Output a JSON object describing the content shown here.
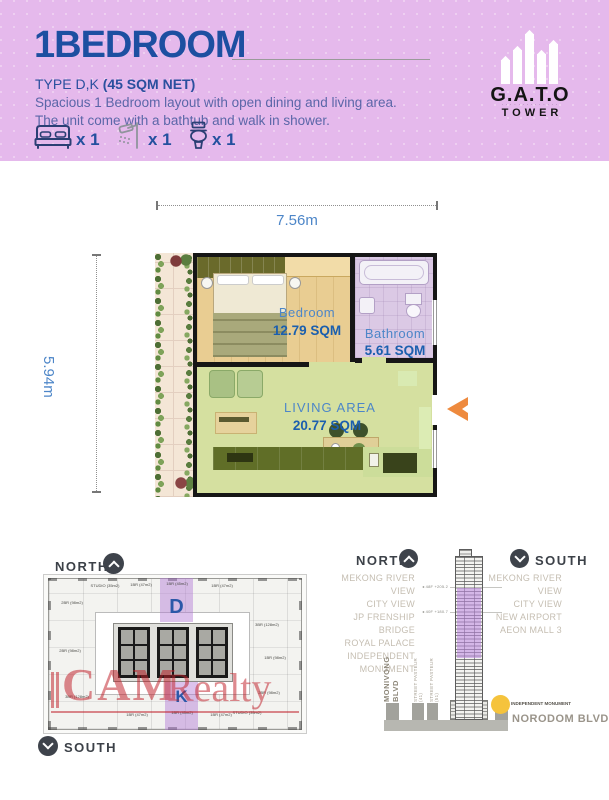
{
  "header": {
    "title": "1BEDROOM",
    "type_prefix": "TYPE D,K ",
    "type_bold": "(45 SQM NET)",
    "desc1": "Spacious 1 Bedroom layout with open dining and living area.",
    "desc2": "The unit come with a bathtub and walk in shower.",
    "features": {
      "bed": "x 1",
      "shower": "x 1",
      "toilet": "x 1"
    },
    "logo": {
      "name": "G.A.T.O",
      "tagline": "· · · · · · · · · · · · · ·",
      "sub": "TOWER"
    }
  },
  "floorplan": {
    "dim_width": "7.56m",
    "dim_height": "5.94m",
    "bedroom": {
      "name": "Bedroom",
      "area": "12.79 SQM"
    },
    "bathroom": {
      "name": "Bathroom",
      "area": "5.61 SQM"
    },
    "living": {
      "name": "LIVING AREA",
      "area": "20.77 SQM"
    },
    "balcony": {
      "name": "BALCONY",
      "area": "7.94 SQM"
    }
  },
  "floorplate": {
    "north": "NORTH",
    "south": "SOUTH",
    "unit_d": "D",
    "unit_k": "K",
    "units": [
      "STUDIO (35m2)",
      "1BR (47m2)",
      "1BR (45m2)",
      "1BR (47m2)",
      "2BR (98m2)",
      "2BR (98m2)",
      "3BR (128m2)",
      "3BR (128m2)",
      "1BR (98m2)",
      "2BR (98m2)",
      "1BR (47m2)",
      "1BR (45m2)",
      "1BR (47m2)",
      "STUDIO (35m2)"
    ],
    "watermark": {
      "part1": "CAM",
      "part2": "Realty"
    }
  },
  "tower_panel": {
    "north_label": "NORTH",
    "south_label": "SOUTH",
    "north_views": [
      "MEKONG RIVER VIEW",
      "CITY VIEW",
      "JP FRENSHIP BRIDGE",
      "ROYAL PALACE",
      "INDEPENDENT",
      "MONUMENT"
    ],
    "south_views": [
      "MEKONG RIVER VIEW",
      "CITY VIEW",
      "NEW AIRPORT",
      "AEON MALL 3"
    ],
    "annotations": [
      "48F  +205.2",
      "40F  +180.7"
    ],
    "streets": [
      "MONIVONG BLVD",
      "STREET PASTEUR (41)",
      "STREET PASTEUR (51)"
    ],
    "landmark": "INDEPENDENT MONUMENT",
    "bottom_street": "NORODOM BLVD"
  },
  "colors": {
    "header_purple": "#e5b9ec",
    "title_blue": "#1d4fa1",
    "label_blue": "#4d86c8",
    "area_blue": "#1b5fae",
    "highlight_purple": "#b177d5",
    "watermark_red": "#c1202a",
    "arrow_orange": "#ee8a3e",
    "landmark_yellow": "#f5c33c"
  }
}
